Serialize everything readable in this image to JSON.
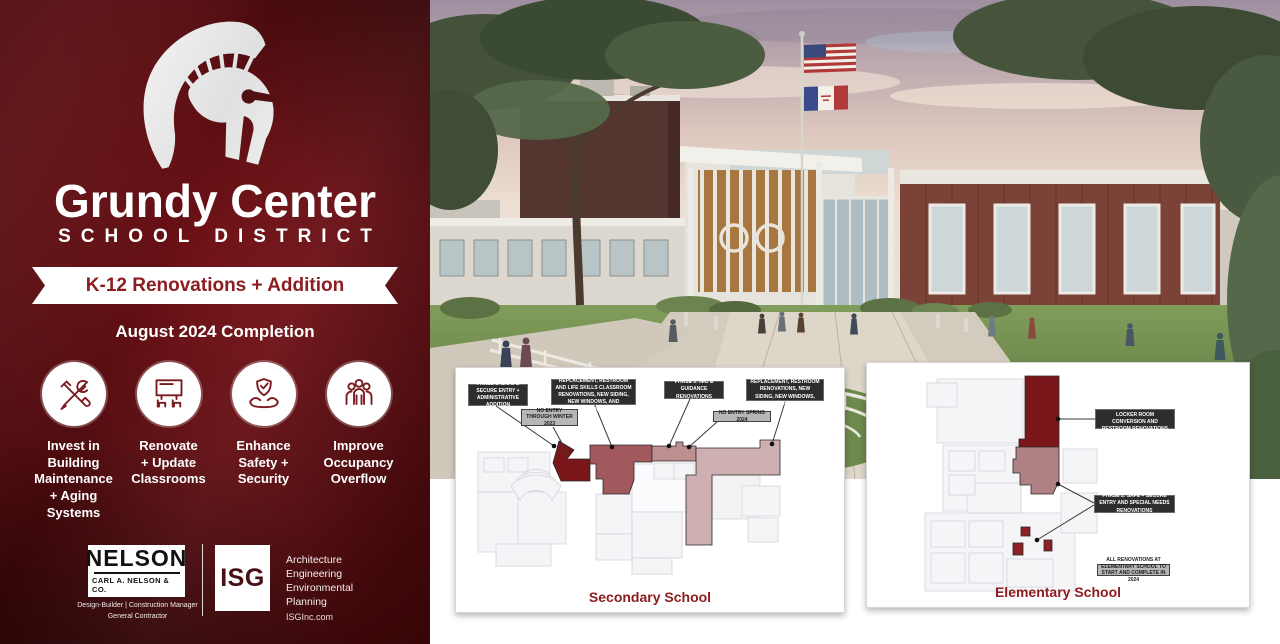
{
  "brand": {
    "title": "Grundy Center",
    "subtitle": "SCHOOL DISTRICT",
    "ribbon": "K-12 Renovations + Addition",
    "completion": "August 2024 Completion"
  },
  "features": [
    {
      "icon": "tools-icon",
      "label": "Invest in\nBuilding\nMaintenance\n+ Aging Systems"
    },
    {
      "icon": "classroom-icon",
      "label": "Renovate\n+ Update\nClassrooms"
    },
    {
      "icon": "shield-hands-icon",
      "label": "Enhance\nSafety +\nSecurity"
    },
    {
      "icon": "people-icon",
      "label": "Improve\nOccupancy\nOverflow"
    }
  ],
  "partners": {
    "nelson": {
      "name": "NELSON",
      "subname": "CARL A. NELSON & CO.",
      "roles": "Design-Builder | Construction Manager\nGeneral Contractor"
    },
    "isg": {
      "name": "ISG",
      "services": "Architecture\nEngineering\nEnvironmental\nPlanning",
      "website": "ISGInc.com"
    }
  },
  "plans": {
    "secondary": {
      "caption": "Secondary School",
      "phase1": "PHASE 1: SAFE & SECURE ENTRY + ADMINISTRATIVE ADDITION",
      "phase2": "PHASE 2: WEST WING HVAC REPLACEMENT, RESTROOM AND LIFE SKILLS CLASSROOM RENOVATIONS, NEW SIDING, NEW WINDOWS, AND REROOFING",
      "phase3": "PHASE 3: IMC & GUIDANCE RENOVATIONS",
      "phase4": "PHASE 4: EAST WING HVAC REPLACEMENT, RESTROOM RENOVATIONS, NEW SIDING, NEW WINDOWS, AND REROOFING",
      "note1": "NO ENTRY THROUGH WINTER 2023",
      "note2": "NO ENTRY SPRING 2024"
    },
    "elementary": {
      "caption": "Elementary School",
      "phase1": "PHASE 1: UNDERUTILIZED LOCKER ROOM CONVERSION AND RESTROOM RENOVATIONS",
      "phase2": "PHASE 2: SAFE + SECURE ENTRY AND SPECIAL NEEDS RENOVATIONS",
      "note": "ALL RENOVATIONS AT ELEMENTARY SCHOOL TO START AND COMPLETE IN 2024"
    }
  },
  "accents": {
    "maroon_background": "#5d0e12",
    "maroon_text": "#8c1d20",
    "phase1_color": "#7a161a",
    "phase2_color": "#a2595d",
    "phase3_color": "#bd8f91",
    "phase4_color": "#cfb0b2",
    "callout_bg": "#2e2d2d",
    "note_bg": "#b7b7b7"
  }
}
